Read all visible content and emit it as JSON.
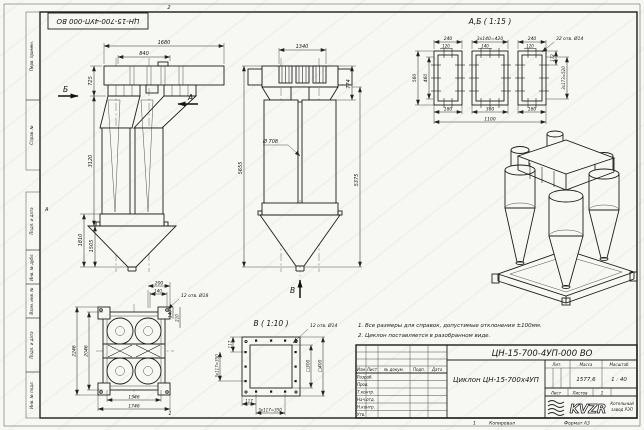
{
  "frame": {
    "stamp": "ЦН-15-700-4УП-000 ВО",
    "zone_top": "2",
    "zone_left": "А",
    "zone_bottom": "1",
    "strip_num": "1",
    "copy": "Копировал",
    "format": "Формат А3",
    "margin": {
      "m1": "Перв. примен.",
      "m2": "Справ. №",
      "m3": "Подп. и дата",
      "m4": "Инв. № дубл.",
      "m5": "Взам. инв. №",
      "m6": "Подп. и дата",
      "m7": "Инв. № подл."
    }
  },
  "front": {
    "w1": "1680",
    "w2": "840",
    "h1": "725",
    "h2": "3120",
    "h3": "1810",
    "h4": "1505",
    "sec_b": "Б",
    "sec_a": "А"
  },
  "side": {
    "w1": "1340",
    "h1": "774",
    "dia": "Ø 708",
    "h2": "5655",
    "h3": "5375",
    "sec_v": "В"
  },
  "ab": {
    "title": "А,Б ( 1:15 )",
    "t1": "240",
    "t2": "3x140=420",
    "t3": "240",
    "s1": "120",
    "s2": "140",
    "s3": "120",
    "holes": "32 отв. Ø14",
    "l1": "560",
    "l2": "460",
    "r1": "172",
    "r2": "3x173=520",
    "b1": "180",
    "b2": "360",
    "b3": "180",
    "b4": "1100"
  },
  "plan": {
    "t1": "200",
    "t2": "140",
    "holes": "12 отв. Ø18",
    "c1": "140",
    "c2": "210",
    "l1": "2246",
    "l2": "2046",
    "b1": "1546",
    "b2": "1746"
  },
  "dv": {
    "title": "В ( 1:10 )",
    "holes": "12 отв. Ø14",
    "l1": "3x117=350",
    "l2": "117",
    "r1": "□300",
    "r2": "□400",
    "b1": "117",
    "b2": "3x117=350"
  },
  "notes": {
    "n1": "1. Все размеры для справок, допустимые отклонения ±100мм.",
    "n2": "2. Циклон поставляется в разобранном виде."
  },
  "tb": {
    "doc": "ЦН-15-700-4УП-000 ВО",
    "name": "Циклон ЦН-15-700x4УП",
    "c1": "Изм",
    "c2": "Лист",
    "c3": "№ докум.",
    "c4": "Подп.",
    "c5": "Дата",
    "r1": "Разраб.",
    "r2": "Пров.",
    "r3": "Т.контр.",
    "r4": "Нач.отд.",
    "r5": "Н.контр.",
    "r6": "Утв.",
    "lit": "Лит.",
    "mass": "Масса",
    "scale": "Масштаб",
    "mass_v": "1577,6",
    "scale_v": "1 : 40",
    "sheet": "Лист",
    "sheets": "Листов",
    "sheets_v": "1",
    "logo": "KVZR",
    "co1": "Котельный",
    "co2": "завод РЭП"
  }
}
